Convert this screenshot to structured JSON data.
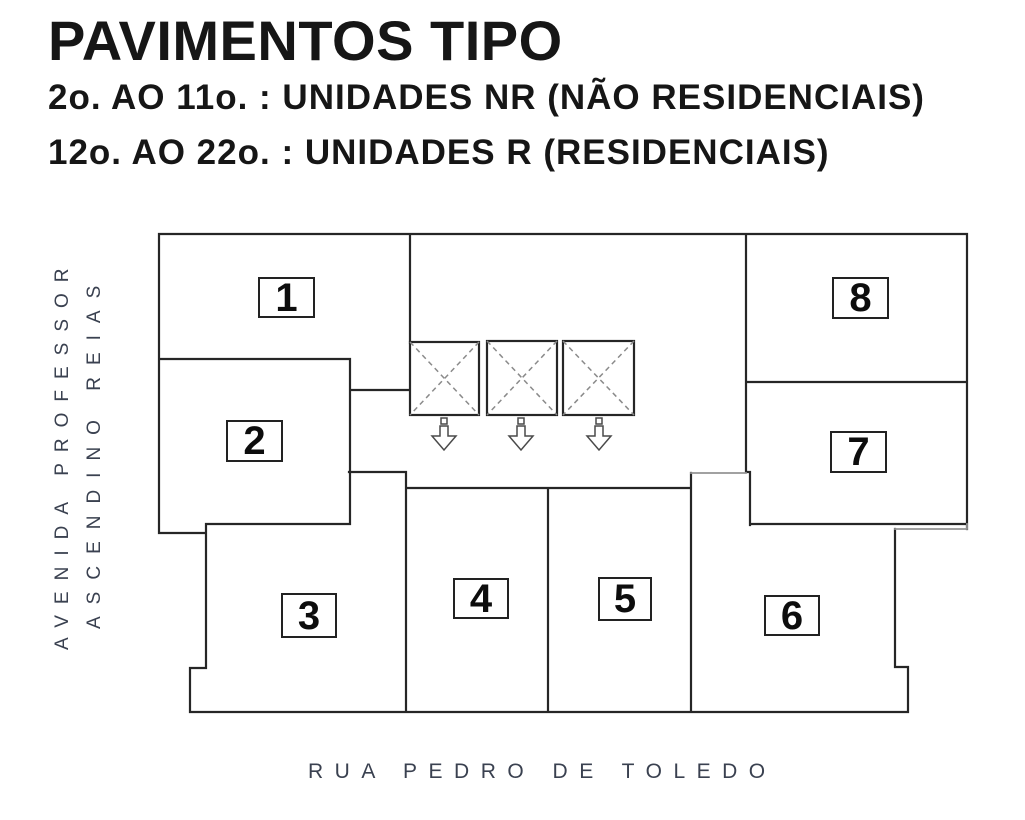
{
  "header": {
    "title": "PAVIMENTOS TIPO",
    "subtitle_1": "2o. AO 11o. : UNIDADES NR (NÃO RESIDENCIAIS)",
    "subtitle_2": "12o. AO 22o. : UNIDADES R (RESIDENCIAIS)"
  },
  "streets": {
    "left_line_1": "AVENIDA PROFESSOR",
    "left_line_2": "ASCENDINO REIAS",
    "bottom": "RUA PEDRO DE TOLEDO"
  },
  "plan": {
    "units": [
      {
        "label": "1"
      },
      {
        "label": "2"
      },
      {
        "label": "3"
      },
      {
        "label": "4"
      },
      {
        "label": "5"
      },
      {
        "label": "6"
      },
      {
        "label": "7"
      },
      {
        "label": "8"
      }
    ],
    "elevator_shafts": 3,
    "colors": {
      "wall": "#262626",
      "wall_light": "#949494",
      "shaft_diagonal": "#8a8a8a",
      "arrow_outline": "#4a4a4a",
      "street_text": "#3a4150",
      "heading_text": "#161616",
      "background": "#ffffff"
    }
  }
}
